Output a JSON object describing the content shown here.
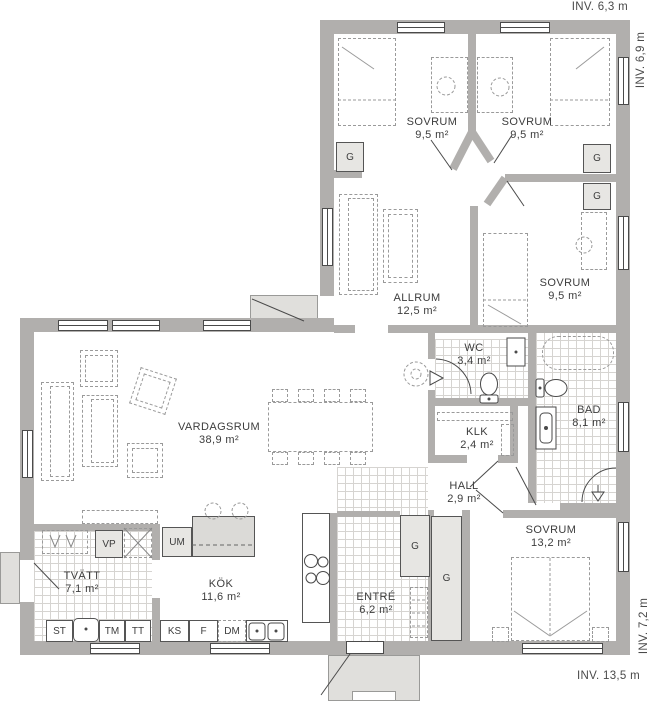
{
  "plan": {
    "dimensions": {
      "top": "INV. 6,3 m",
      "right_upper": "INV. 6,9 m",
      "right_lower": "INV. 7,2 m",
      "bottom": "INV. 13,5 m"
    },
    "rooms": [
      {
        "name": "SOVRUM",
        "area": "9,5 m²"
      },
      {
        "name": "SOVRUM",
        "area": "9,5 m²"
      },
      {
        "name": "SOVRUM",
        "area": "9,5 m²"
      },
      {
        "name": "ALLRUM",
        "area": "12,5 m²"
      },
      {
        "name": "WC",
        "area": "3,4 m²"
      },
      {
        "name": "BAD",
        "area": "8,1 m²"
      },
      {
        "name": "KLK",
        "area": "2,4 m²"
      },
      {
        "name": "HALL",
        "area": "2,9 m²"
      },
      {
        "name": "VARDAGSRUM",
        "area": "38,9 m²"
      },
      {
        "name": "SOVRUM",
        "area": "13,2 m²"
      },
      {
        "name": "ENTRÉ",
        "area": "6,2 m²"
      },
      {
        "name": "KÖK",
        "area": "11,6 m²"
      },
      {
        "name": "TVÄTT",
        "area": "7,1 m²"
      }
    ],
    "fixtures": {
      "g": "G",
      "vp": "VP",
      "um": "UM",
      "st": "ST",
      "tm": "TM",
      "tt": "TT",
      "ks": "KS",
      "f": "F",
      "dm": "DM"
    },
    "colors": {
      "wall": "#b1afad",
      "porch": "#e0dfdc"
    }
  }
}
